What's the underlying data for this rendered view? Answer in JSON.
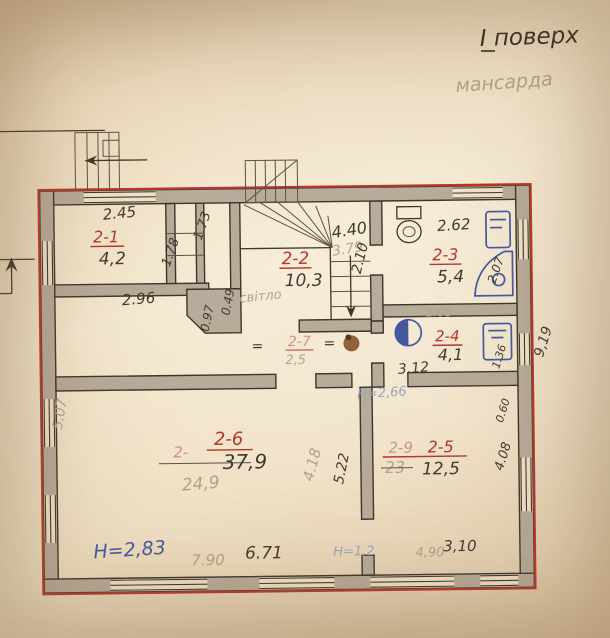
{
  "header": {
    "floor_label": "І поверх",
    "sub_label": "мансарда"
  },
  "rooms": [
    {
      "id": "2-1",
      "area": "4,2"
    },
    {
      "id": "2-2",
      "area": "10,3",
      "note": "світло"
    },
    {
      "id": "2-3",
      "area": "5,4"
    },
    {
      "id": "2-4",
      "area": "4,1"
    },
    {
      "id": "2-7",
      "area": "2,5",
      "strike_left": "=",
      "strike_right": "="
    },
    {
      "id": "2-6",
      "area": "37,9",
      "old_id": "2-",
      "old_area": "24,9"
    },
    {
      "id": "2-5",
      "area": "12,5",
      "old_id": "2-9",
      "old_area": "23"
    }
  ],
  "dims": {
    "room21_top": "2.45",
    "shaft_right": "1.73",
    "shaft_left": "1.78",
    "room21_bottom": "2.96",
    "left_wall": "5.07",
    "stair_top": "4.40",
    "stair_top_old": "3.79",
    "niche_depth": "0.97",
    "niche_width": "0.49",
    "stair_right": "2.10",
    "room23_top": "2.62",
    "room23_right": "2.07",
    "room23_bottom": "2.05",
    "corridor_right": "3.12",
    "room24_right": "1.36",
    "right_upper": "0.60",
    "room25_right": "4.08",
    "right_total": "9,19",
    "room26_mid": "4.18",
    "room25_left": "5.22",
    "room26_bottom": "6.71",
    "room26_bottom_old": "7.90",
    "room25_bottom": "3,10",
    "room25_bottom_old": "4,90"
  },
  "notes": {
    "height_main": "Н=2,83",
    "height_door": "Н=2,66",
    "height_low": "Н=1,2"
  },
  "colors": {
    "red_marker": "#b5372b",
    "blue_ink": "#45589f",
    "pencil": "#423a31",
    "faded_pencil": "#b3a48c",
    "paper": "#f0e3c8",
    "wall_fill": "#b7ab99"
  }
}
